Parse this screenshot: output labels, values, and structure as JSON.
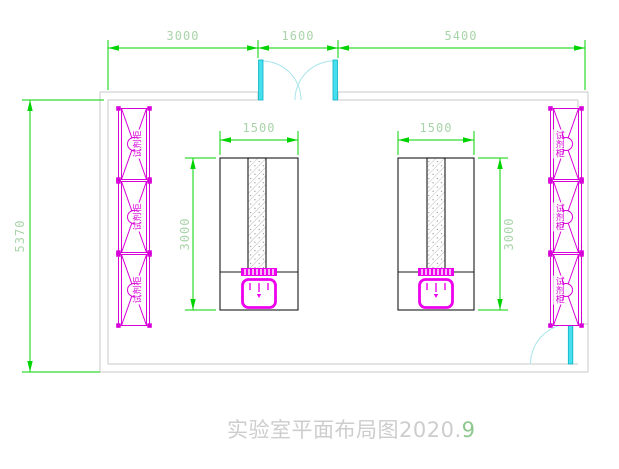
{
  "title": {
    "text": "实验室平面布局图2020.",
    "suffix": "9"
  },
  "dimensions": {
    "top_left": "3000",
    "top_middle": "1600",
    "top_right": "5400",
    "side_left": "5370",
    "bench1_width": "1500",
    "bench1_height": "3000",
    "bench2_width": "1500",
    "bench2_height": "3000"
  },
  "cabinets": {
    "label": "试剂柜",
    "left_column_count": 3,
    "right_column_count": 3
  },
  "colors": {
    "dimension_line_green": "#00d400",
    "dimension_text_green": "#a9d4a9",
    "cabinet_magenta": "#d800d8",
    "sink_magenta": "#ee00ee",
    "door_cyan": "#45dfee",
    "wall_gray": "#c8c8c8",
    "bench_outline_black": "#1a1a1a",
    "title_gray": "#cdcdcd",
    "title_suffix_green": "#8ec88e"
  }
}
